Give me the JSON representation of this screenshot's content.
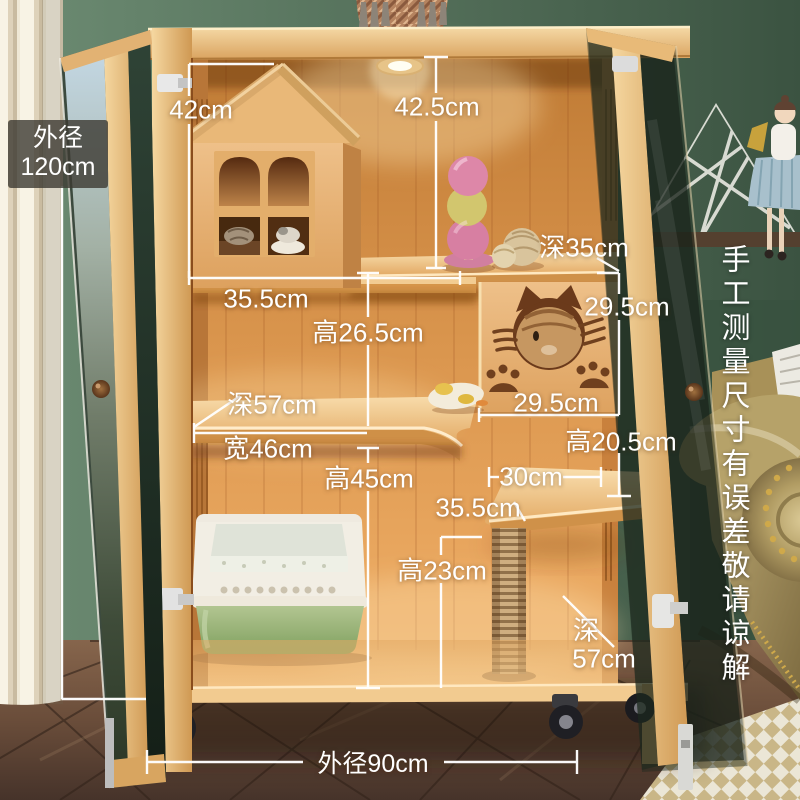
{
  "badge": {
    "label_line1": "外径",
    "label_line2": "120cm"
  },
  "dimensions": {
    "house_height": "42cm",
    "top_section_height": "42.5cm",
    "top_shelf_depth": "深35cm",
    "house_width": "35.5cm",
    "middle_section_height": "高26.5cm",
    "panel_opening_height": "29.5cm",
    "panel_opening_width": "29.5cm",
    "middle_shelf_depth": "深57cm",
    "middle_shelf_width": "宽46cm",
    "perch_clearance_height": "高20.5cm",
    "lower_section_height": "高45cm",
    "perch_width": "30cm",
    "perch_depth": "35.5cm",
    "post_section_height": "高23cm",
    "bottom_depth_prefix": "深",
    "bottom_depth_value": "57cm",
    "outer_width": "外径90cm"
  },
  "notice": {
    "column1": "手工测量尺寸",
    "column2": "有误差敬请谅解"
  },
  "scene_items": [
    "hanging-basket",
    "wall-shelf-with-doll",
    "cat-villa-cabinet",
    "cat-house",
    "ball-stack-toy",
    "yarn-balls",
    "cat-face-panel",
    "plush-toy",
    "perch-platform",
    "scratching-post",
    "litter-box",
    "glass-doors",
    "casters",
    "curtains",
    "leather-sofa",
    "parquet-floor",
    "checkered-rug"
  ],
  "colors": {
    "annotation": "#ffffff",
    "wood_light": "#edc286",
    "wood_interior": "#e09a54",
    "wall_green": "#6d8c73",
    "litter_box_green": "#9db77c",
    "sofa_khaki": "#b2a068",
    "floor_brown": "#5d4535",
    "badge_bg": "rgba(60,58,50,0.8)"
  }
}
